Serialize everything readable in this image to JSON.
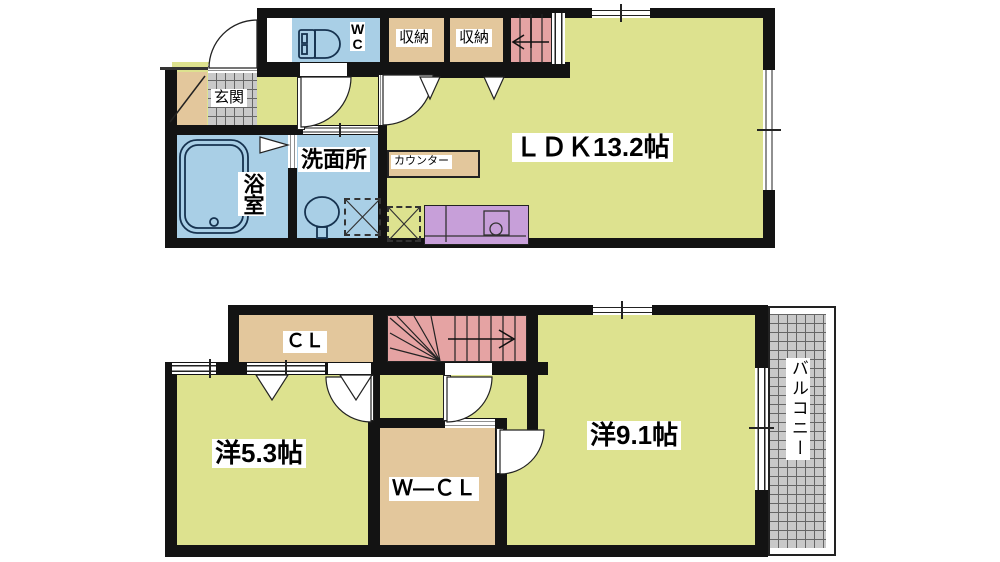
{
  "title": "2-story apartment floor plan",
  "labels": {
    "ldk": "ＬＤＫ13.2帖",
    "wc_w": "W",
    "wc_c": "C",
    "storage1": "収納",
    "storage2": "収納",
    "genkan": "玄関",
    "bath": "浴室",
    "washroom": "洗面所",
    "counter": "カウンター",
    "cl": "ＣＬ",
    "room53": "洋5.3帖",
    "wcl": "Ｗ―ＣＬ",
    "room91": "洋9.1帖",
    "balcony": "バルコニー"
  },
  "colors": {
    "wall": "#131313",
    "room_yellow": "#dde28f",
    "water_blue": "#a9cfe6",
    "closet_tan": "#e3c79c",
    "stair_pink": "#e5a3a3",
    "tile_gray": "#c9c9c9",
    "kitchen_purple": "#c79fd9"
  }
}
